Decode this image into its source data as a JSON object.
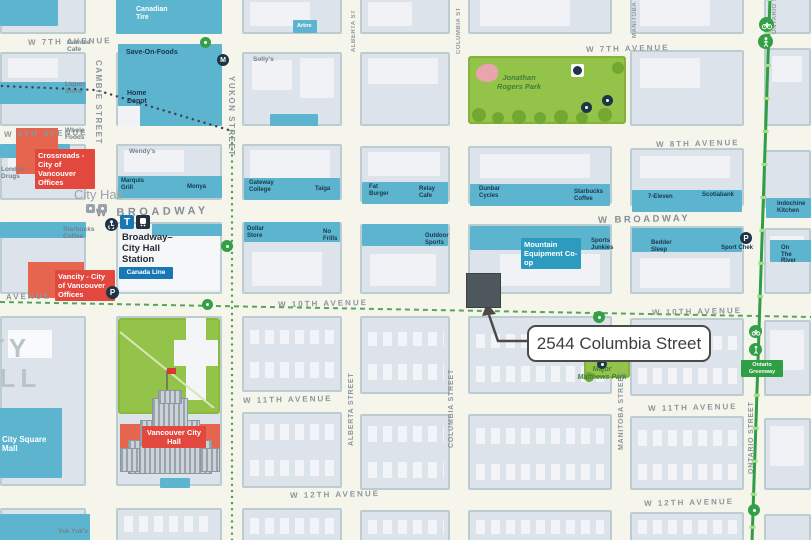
{
  "callout": {
    "address": "2544 Columbia Street"
  },
  "area_labels": {
    "district_line1": "CITY",
    "district_line2": "HALL",
    "city_hall_small": "City Hall"
  },
  "avenues": [
    "W 7TH AVENUE",
    "W 7TH AVENUE",
    "W 8TH AVENUE",
    "W 8TH AVENUE",
    "W BROADWAY",
    "W BROADWAY",
    "AVENUE",
    "W 10TH AVENUE",
    "W 10TH AVENUE",
    "W 11TH AVENUE",
    "W 11TH AVENUE",
    "W 12TH AVENUE",
    "W 12TH AVENUE"
  ],
  "streets": {
    "cambie": "CAMBIE STREET",
    "yukon": "YUKON STREET",
    "alberta_top": "ALBERTA ST",
    "alberta": "ALBERTA STREET",
    "columbia_top": "COLUMBIA ST",
    "columbia": "COLUMBIA STREET",
    "manitoba_top": "MANITOBA ST",
    "manitoba": "MANITOBA STREET",
    "ontario_top": "ONTARIO ST",
    "ontario": "ONTARIO STREET"
  },
  "station": {
    "name_line1": "Broadway–",
    "name_line2": "City Hall",
    "name_line3": "Station",
    "line_badge": "Canada Line"
  },
  "badges": {
    "crossroads": "Crossroads - City of Vancouver Offices",
    "vancity": "Vancity - City of Vancouver Offices",
    "mec": "Mountain Equipment Co-op",
    "ontario_greenway": "Ontario Greenway",
    "vancouver_city_hall": "Vancouver City Hall",
    "city_square_mall": "City Square Mall"
  },
  "parks": {
    "jonathan_rogers": "Jonathan Rogers Park",
    "major_matthews": "Major Matthews Park"
  },
  "shops": {
    "canadian_tire": "Canadian Tire",
    "save_on_foods": "Save-On-Foods",
    "home_depot": "Home Depot",
    "arbre": "Arbre",
    "marquis_grill": "Marquis Grill",
    "monya": "Monya",
    "gateway_college": "Gateway College",
    "taiga": "Taiga",
    "fat_burger": "Fat Burger",
    "relay_cafe": "Relay Cafe",
    "dunbar_cycles": "Dunbar Cycles",
    "starbucks_coffee": "Starbucks Coffee",
    "seven_eleven": "7-Eleven",
    "scotiabank": "Scotiabank",
    "indochine_kitchen": "Indochine Kitchen",
    "dollar_store": "Dollar Store",
    "no_frills": "No Frills",
    "outdoor_sports": "Outdoor Sports",
    "sports_junkies": "Sports Junkies",
    "bedder_sleep": "Bedder Sleep",
    "sport_chek": "Sport Chek",
    "on_the_river": "On The River"
  },
  "gray_labels": {
    "cambie_cafe": "Cambie Cafe",
    "liquor_store": "Liquor Store",
    "whole_foods": "Whole Foods",
    "london_drugs": "London Drugs",
    "wendys": "Wendy's",
    "sollys": "Solly's",
    "yuk_yuks": "Yuk Yuk's"
  },
  "colors": {
    "commercial_teal": "#5db4cf",
    "park_green": "#93c348",
    "route_green": "#2f9e44",
    "red_badge": "#e2483d",
    "canada_line_blue": "#1878b4",
    "mec_blue": "#2d9bc0",
    "marker_dark": "#4e575c"
  }
}
